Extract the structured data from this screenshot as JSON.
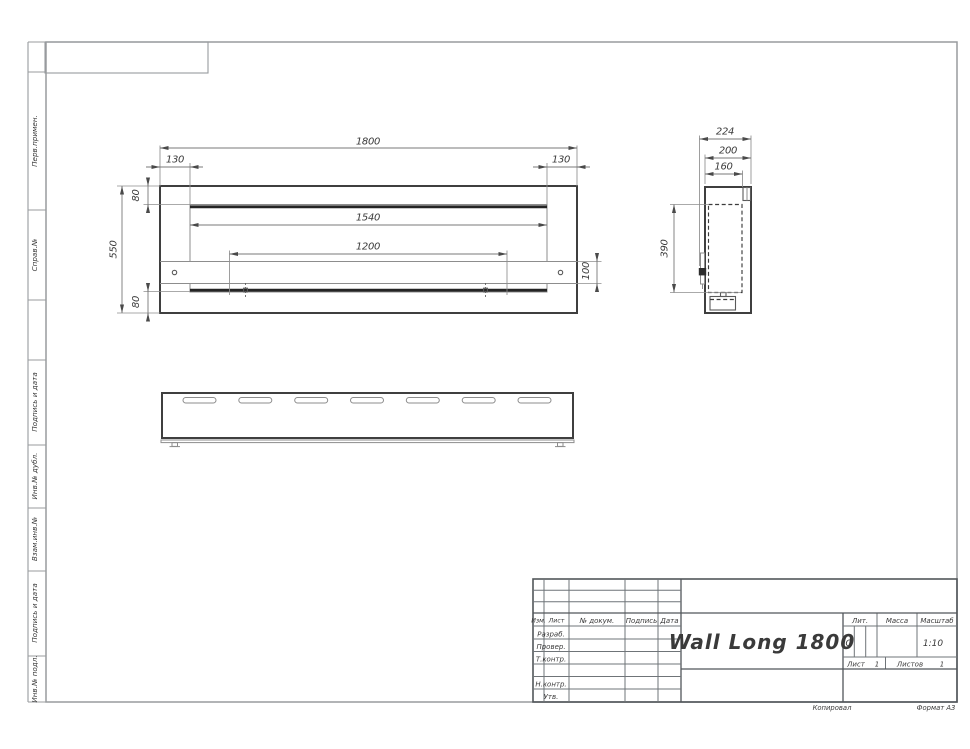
{
  "document": {
    "title": "Wall Long 1800",
    "format": "Формат А3",
    "copied_by": "Копировал",
    "scale": "1:10",
    "liter": "О",
    "sheet_label": "Лист",
    "sheet_value": "1",
    "sheets_label": "Листов",
    "sheets_value": "1",
    "lit_label": "Лит.",
    "mass_label": "Масса",
    "scale_label": "Масштаб"
  },
  "stamp": {
    "header": [
      "Изм.",
      "Лист",
      "№ докум.",
      "Подпись",
      "Дата"
    ],
    "rows": [
      "Разраб.",
      "Провер.",
      "Т.контр.",
      "Н.контр.",
      "Утв."
    ]
  },
  "margin": [
    "Перв.примен.",
    "Справ.№",
    "Подпись и дата",
    "Инв.№ дубл.",
    "Взам.инв.№",
    "Подпись и дата",
    "Инв.№ подл."
  ],
  "dims": {
    "front": {
      "overall_width": "1800",
      "offset_left": "130",
      "offset_right": "130",
      "opening_width": "1540",
      "inner_width": "1200",
      "overall_height": "550",
      "top_offset": "80",
      "bottom_offset": "80",
      "strip_height": "100"
    },
    "side": {
      "overall_depth": "224",
      "body_depth": "200",
      "inner_depth": "160",
      "opening_height": "390"
    }
  },
  "palette": {
    "paper": "#ffffff",
    "ink": "#3a3a3a",
    "contour": "#3f3f3f",
    "thin_line": "#8e8e8e",
    "frame": "#989b9e"
  }
}
